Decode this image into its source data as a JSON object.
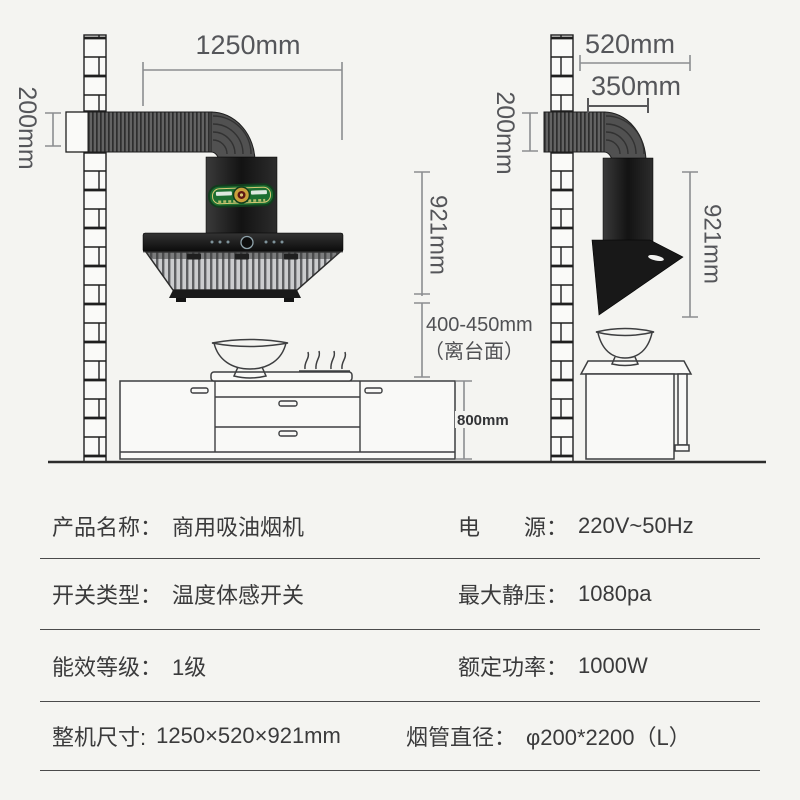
{
  "diagram": {
    "front_view": {
      "width_label": "1250mm",
      "duct_height_label": "200mm",
      "hood_height_label": "921mm",
      "clearance_label": "400-450mm",
      "clearance_note": "（离台面）",
      "counter_height_label": "800mm"
    },
    "side_view": {
      "depth_label": "520mm",
      "upper_depth_label": "350mm",
      "duct_height_label": "200mm",
      "hood_height_label": "921mm"
    },
    "colors": {
      "background": "#f4f4f1",
      "dimension_line": "#8b8d90",
      "dimension_text": "#55565a",
      "hood_black": "#1a1a1a",
      "badge_green": "#1c6f31",
      "badge_gold": "#caa13c"
    }
  },
  "specs": {
    "rows": [
      {
        "left_label": "产品名称：",
        "left_value": "商用吸油烟机",
        "right_label": "电　　源：",
        "right_value": "220V~50Hz"
      },
      {
        "left_label": "开关类型：",
        "left_value": "温度体感开关",
        "right_label": "最大静压：",
        "right_value": "1080pa"
      },
      {
        "left_label": "能效等级：",
        "left_value": "1级",
        "right_label": "额定功率：",
        "right_value": "1000W"
      },
      {
        "left_label": "整机尺寸:",
        "left_value": "1250×520×921mm",
        "right_label": "烟管直径：",
        "right_value": "φ200*2200（L）"
      }
    ]
  }
}
